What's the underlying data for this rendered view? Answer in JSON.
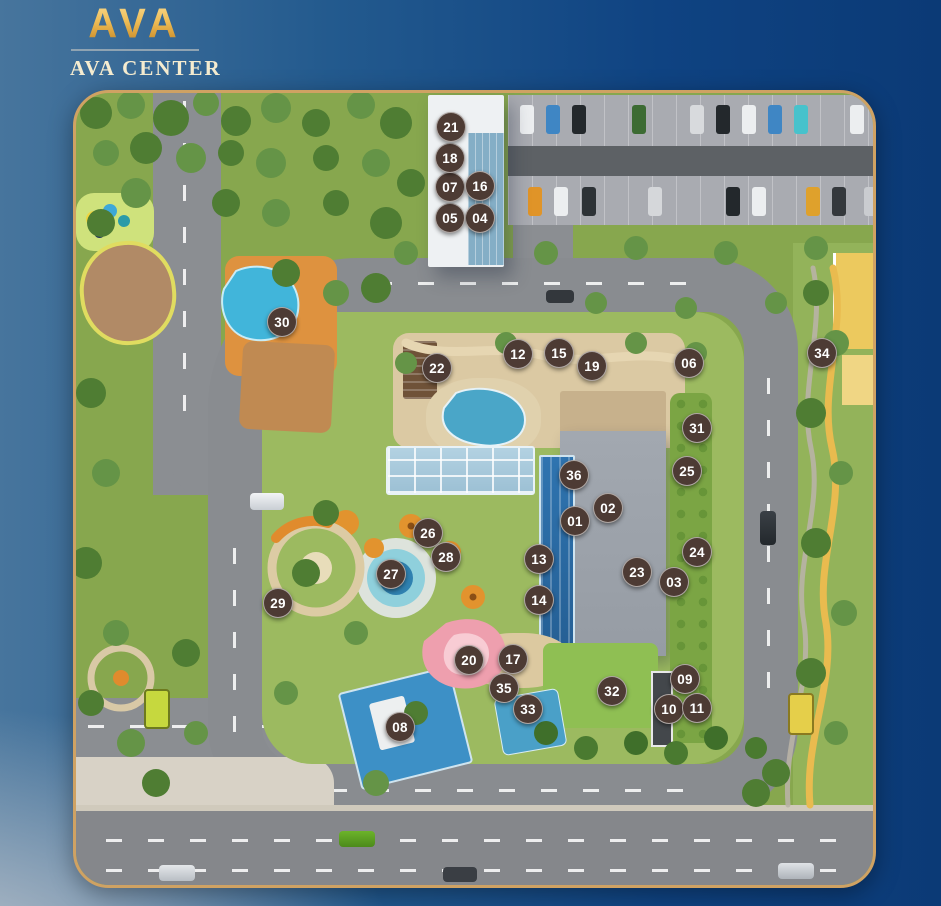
{
  "brand": {
    "logo_text": "AVA",
    "name": "AVA CENTER"
  },
  "site_map": {
    "colors": {
      "marker_bg": "#4d3b34",
      "marker_text": "#ffffff",
      "map_border": "#cfa263",
      "background_navy": "#0b3a76",
      "accent_gold": "#eebc55"
    },
    "markers": [
      {
        "label": "01",
        "x": 575,
        "y": 521
      },
      {
        "label": "02",
        "x": 608,
        "y": 508
      },
      {
        "label": "03",
        "x": 674,
        "y": 582
      },
      {
        "label": "04",
        "x": 480,
        "y": 218
      },
      {
        "label": "05",
        "x": 450,
        "y": 218
      },
      {
        "label": "06",
        "x": 689,
        "y": 363
      },
      {
        "label": "07",
        "x": 450,
        "y": 187
      },
      {
        "label": "08",
        "x": 400,
        "y": 727
      },
      {
        "label": "09",
        "x": 685,
        "y": 679
      },
      {
        "label": "10",
        "x": 669,
        "y": 709
      },
      {
        "label": "11",
        "x": 697,
        "y": 708
      },
      {
        "label": "12",
        "x": 518,
        "y": 354
      },
      {
        "label": "13",
        "x": 539,
        "y": 559
      },
      {
        "label": "14",
        "x": 539,
        "y": 600
      },
      {
        "label": "15",
        "x": 559,
        "y": 353
      },
      {
        "label": "16",
        "x": 480,
        "y": 186
      },
      {
        "label": "17",
        "x": 513,
        "y": 659
      },
      {
        "label": "18",
        "x": 450,
        "y": 158
      },
      {
        "label": "19",
        "x": 592,
        "y": 366
      },
      {
        "label": "20",
        "x": 469,
        "y": 660
      },
      {
        "label": "21",
        "x": 451,
        "y": 127
      },
      {
        "label": "22",
        "x": 437,
        "y": 368
      },
      {
        "label": "23",
        "x": 637,
        "y": 572
      },
      {
        "label": "24",
        "x": 697,
        "y": 552
      },
      {
        "label": "25",
        "x": 687,
        "y": 471
      },
      {
        "label": "26",
        "x": 428,
        "y": 533
      },
      {
        "label": "27",
        "x": 391,
        "y": 574
      },
      {
        "label": "28",
        "x": 446,
        "y": 557
      },
      {
        "label": "29",
        "x": 278,
        "y": 603
      },
      {
        "label": "30",
        "x": 282,
        "y": 322
      },
      {
        "label": "31",
        "x": 697,
        "y": 428
      },
      {
        "label": "32",
        "x": 612,
        "y": 691
      },
      {
        "label": "33",
        "x": 528,
        "y": 709
      },
      {
        "label": "34",
        "x": 822,
        "y": 353
      },
      {
        "label": "35",
        "x": 504,
        "y": 688
      },
      {
        "label": "36",
        "x": 574,
        "y": 475
      }
    ]
  }
}
